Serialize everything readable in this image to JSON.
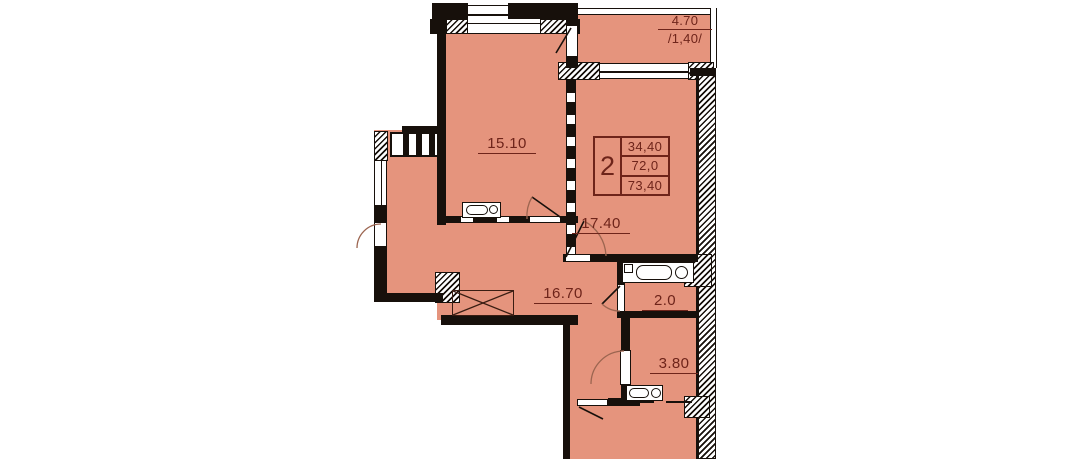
{
  "plan_title": "2-room apartment floor plan",
  "colors": {
    "room_fill": "#E5947D",
    "wall": "#17100B",
    "label_text": "#6E241A",
    "background": "#FFFFFF"
  },
  "rooms": [
    {
      "name": "living-room",
      "area_label": "15.10"
    },
    {
      "name": "bedroom",
      "area_label": "17.40"
    },
    {
      "name": "hallway",
      "area_label": "16.70"
    },
    {
      "name": "bathroom",
      "area_label": "2.0"
    },
    {
      "name": "toilet",
      "area_label": "3.80"
    }
  ],
  "balcony": {
    "area_full": "4.70",
    "area_reduced": "/1,40/"
  },
  "summary_box": {
    "rooms_count": "2",
    "living_area": "34,40",
    "floor_area": "72,0",
    "total_area": "73,40"
  },
  "fixtures": [
    "kitchen-sink",
    "bathtub",
    "washbasin",
    "wardrobe"
  ]
}
